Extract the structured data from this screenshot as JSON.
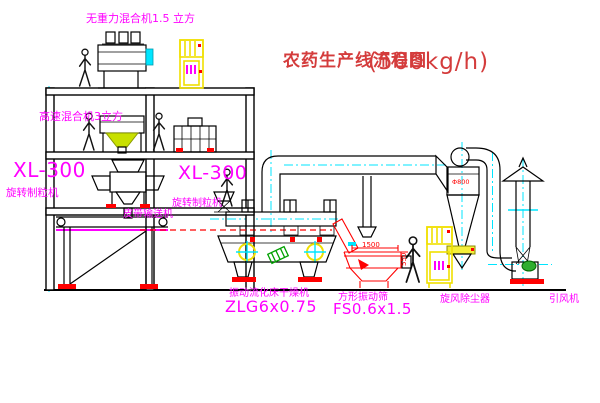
{
  "title": {
    "name": "农药生产线流程图",
    "capacity": "(500kg/h)"
  },
  "labels": {
    "top_mixer": "无重力混合机1.5 立方",
    "second_mixer": "高速混合机3立方",
    "granulator_left_model": "XL-300",
    "granulator_left_name": "旋转制粒机",
    "granulator_mid_model": "XL-300",
    "granulator_mid_name": "旋转制粒机",
    "belt_conveyor": "皮带输送机",
    "dryer_name": "振动流化床干燥机",
    "dryer_model": "ZLG6x0.75",
    "sieve_name": "方形振动筛",
    "sieve_model": "FS0.6x1.5",
    "cyclone_name": "旋风除尘器",
    "fan_name": "引风机"
  },
  "dims": {
    "sieve_width": "1500",
    "sieve_height": "550",
    "cyclone_dia": "Φ800"
  },
  "colors": {
    "label_magenta": "#ff00ff",
    "title_red": "#d43c3c",
    "dimension_red": "#ff0000",
    "cabinet_yellow": "#f0e000",
    "centerline_cyan": "#00e5ff",
    "motor_green": "#00a000",
    "line_black": "#000000",
    "background": "#ffffff"
  }
}
